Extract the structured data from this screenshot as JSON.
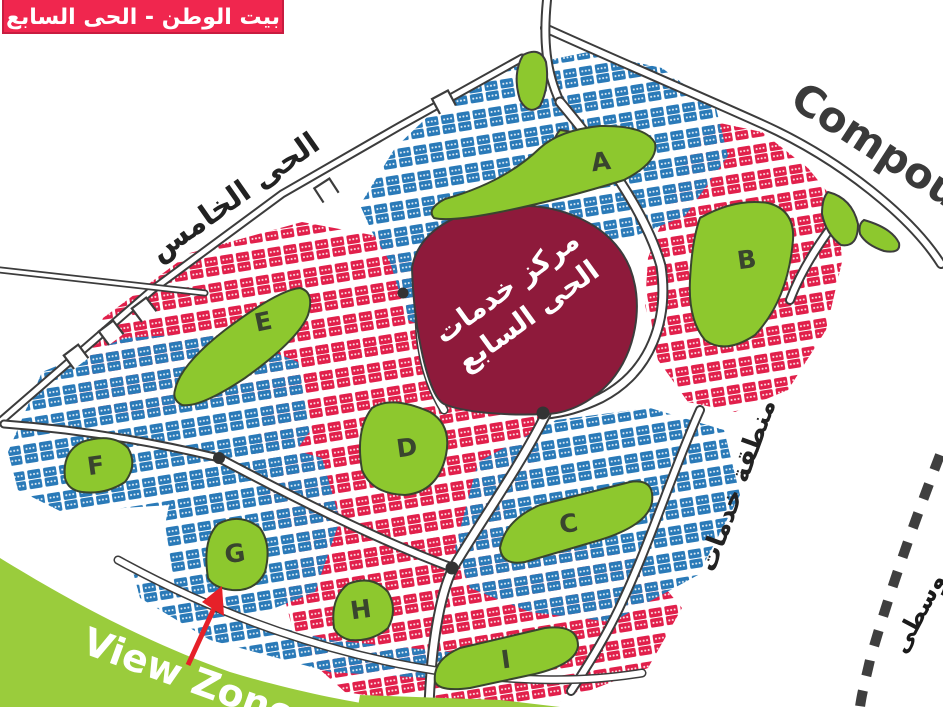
{
  "banner": {
    "text": "بيت الوطن - الحى السابع",
    "bg": "#F0264E",
    "border": "#C81C40",
    "fg": "#FFFFFF"
  },
  "labels": {
    "compound": "Compound",
    "district_five": "الحى الخامس",
    "services_area": "منطقة خدمات",
    "services_center_line1": "مركز خدمات",
    "services_center_line2": "الحى السابع",
    "view_zone": "View Zone",
    "bottom_right_partial": "وسطى"
  },
  "zones": {
    "blocks": [
      "A",
      "B",
      "C",
      "D",
      "E",
      "F",
      "G",
      "H",
      "I"
    ]
  },
  "colors": {
    "blue_plots": "#2A7AB8",
    "red_plots": "#E1204B",
    "maroon_center": "#8E1A3B",
    "block_green": "#8DC82E",
    "view_zone_green": "#9ACC3C",
    "road_dark": "#3C3C3C",
    "arrow_red": "#E62129",
    "text_dark": "#3A3A3A"
  }
}
